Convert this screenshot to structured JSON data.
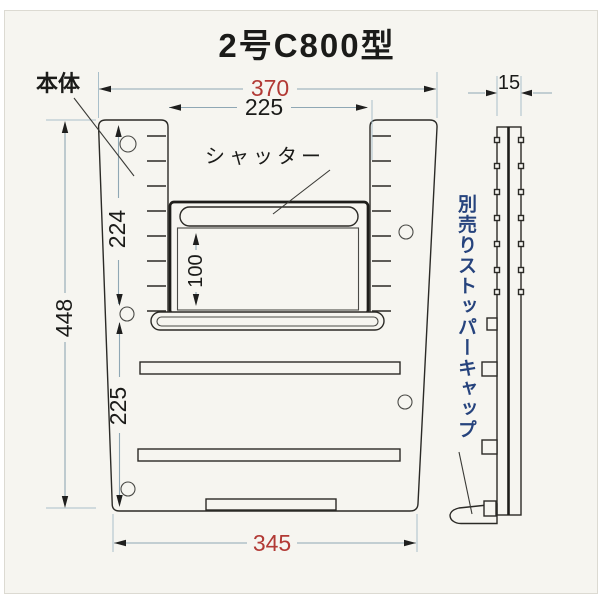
{
  "title": "2号C800型",
  "labels": {
    "body": "本体",
    "shutter": "シャッター",
    "stopper_note": "別売りストッパーキャップ"
  },
  "dimensions": {
    "top_width": "370",
    "top_opening_width": "225",
    "total_height": "448",
    "upper_height": "224",
    "lower_height": "225",
    "shutter_opening_height": "100",
    "bottom_width": "345",
    "side_thickness": "15"
  },
  "colors": {
    "ink": "#2b2a26",
    "dimension_red": "#b23a35",
    "note_blue": "#26437d",
    "guide_line": "#a9bfca",
    "paper": "#f6f5f0"
  }
}
